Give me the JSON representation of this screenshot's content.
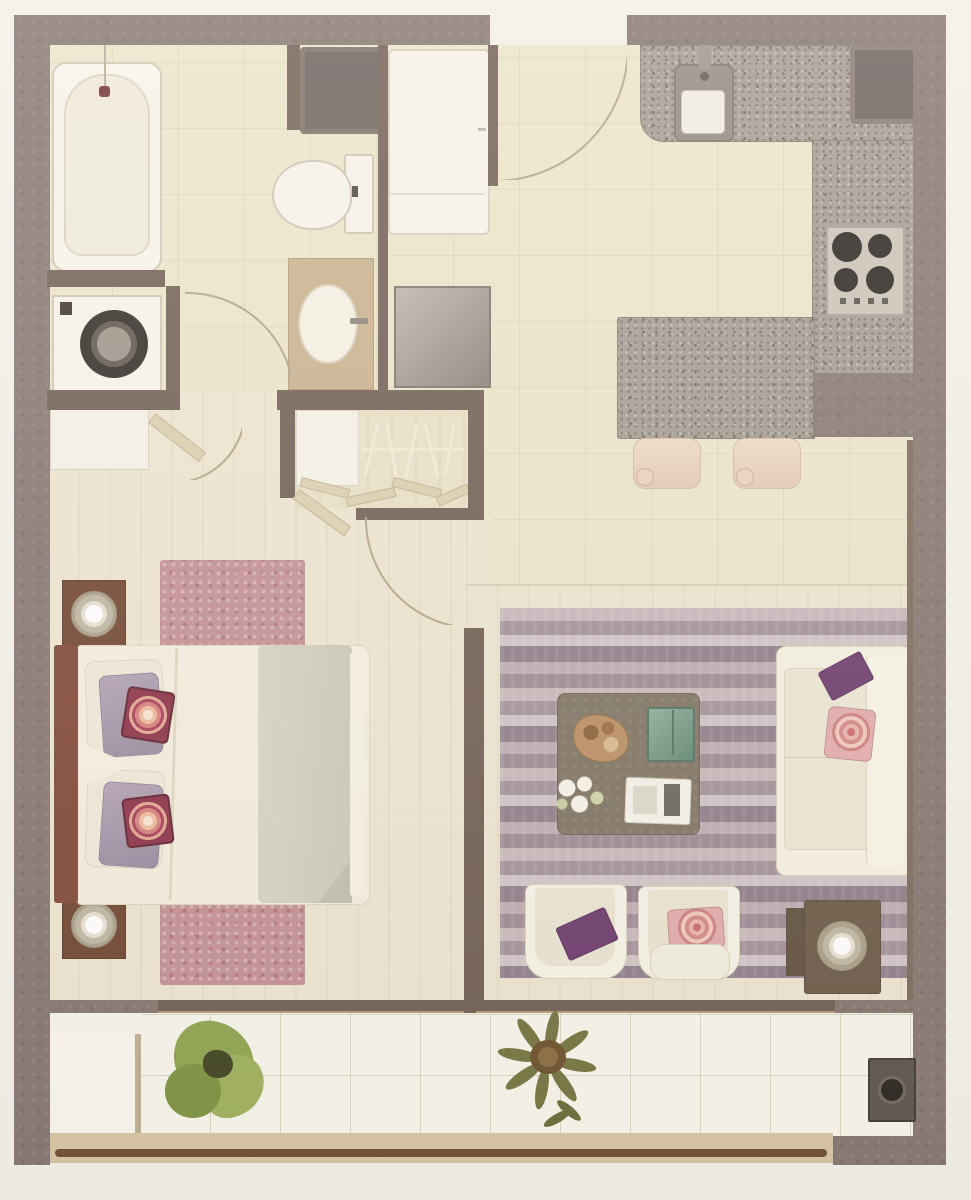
{
  "document": {
    "kind": "apartment-floor-plan-rendering",
    "visible_text": "none",
    "orientation": "top-down"
  },
  "colors": {
    "margin": "#f2f0ea",
    "wall": "#847570",
    "wall-dark": "#6f5d54",
    "tile-floor": "#ebe5cc",
    "tile-line": "#ded7bd",
    "wood-floor": "#ece5d1",
    "granite": "#a39b93",
    "granite-dark": "#7e756e",
    "fixture": "#f7f4ed",
    "fixture-line": "#cfc7b5",
    "vanity": "#c8b28f",
    "dark-square": "#675f5c",
    "pink-rug": "#c28f95",
    "headboard": "#7f4737",
    "nightstand": "#6f4531",
    "bedsheet": "#f3eedf",
    "blanket": "#d3d0c0",
    "lavender": "#a796ac",
    "sofa": "#f2eedf",
    "sofa-line": "#d8d1bb",
    "table-brown": "#7e7363",
    "side-table": "#6b5948",
    "purple": "#6c3a6d",
    "floral": "#e2abab",
    "green-glass": "#5f8673",
    "balcony-tile": "#f7f5ec",
    "balcony-line": "#d9d4c0",
    "plant-green": "#8ea34e",
    "plant-olive": "#72743f",
    "tan-band": "#d6c5a3",
    "railing": "#6a4b31",
    "door-arc": "#b2a488",
    "door-leaf": "#dbceae"
  },
  "rooms": [
    {
      "id": "bathroom",
      "furniture": [
        "bathtub",
        "toilet",
        "vanity-sink",
        "washing-machine",
        "duct-shaft"
      ]
    },
    {
      "id": "entry-hall",
      "furniture": [
        "tall-cabinet",
        "utility-cabinet",
        "entry-door-arc"
      ]
    },
    {
      "id": "kitchen",
      "furniture": [
        "granite-counter",
        "kitchen-sink",
        "refrigerator-square",
        "cooktop-4-burners",
        "breakfast-bar",
        "bar-stool",
        "bar-stool"
      ]
    },
    {
      "id": "closet",
      "furniture": [
        "shelf",
        "hanging-rod",
        "clothes-hangers",
        "bifold-doors"
      ]
    },
    {
      "id": "bedroom",
      "furniture": [
        "double-bed",
        "headboard",
        "pillows",
        "nightstand-lamp",
        "nightstand-lamp",
        "dresser",
        "pink-area-rug"
      ]
    },
    {
      "id": "living-room",
      "furniture": [
        "striped-rug",
        "sofa",
        "armchair",
        "armchair",
        "coffee-table",
        "decor-tray",
        "open-book-tray",
        "flowers",
        "side-table-lamp"
      ]
    },
    {
      "id": "balcony",
      "furniture": [
        "potted-plant-green",
        "potted-plant-olive",
        "floor-drain",
        "railing",
        "sliding-door"
      ]
    }
  ]
}
